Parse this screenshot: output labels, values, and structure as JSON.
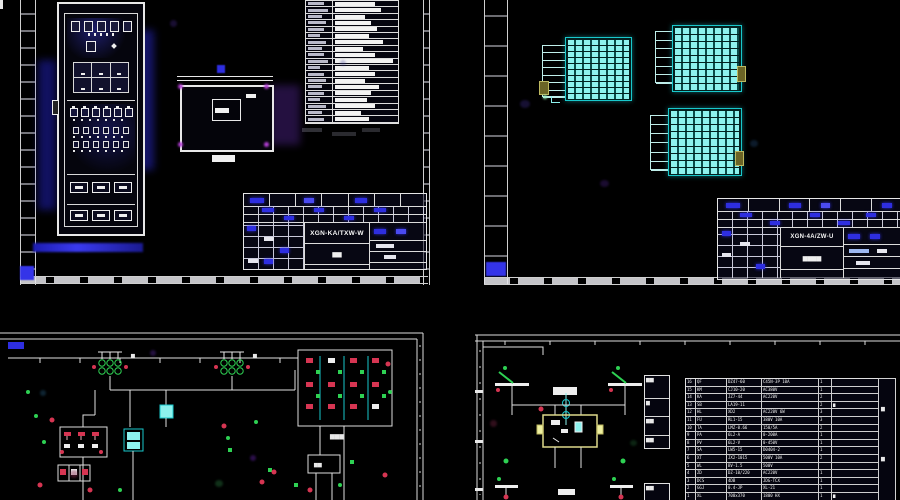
{
  "palette": {
    "line": "#e8e8e8",
    "blue": "#2e2ee0",
    "cyan_fill": "#8df2ee",
    "cyan_line": "#19c8cc",
    "green": "#2ed153",
    "red": "#d63552",
    "yellow": "#ddd98a",
    "magenta": "#a64fd4"
  },
  "sheet1": {
    "name": "cabinet-layout-sheet",
    "wire_table": {
      "left_widths": [
        16,
        20,
        14,
        18,
        16,
        12,
        18,
        14,
        16,
        20,
        12,
        16,
        18,
        14,
        16,
        12,
        18,
        14,
        16
      ],
      "bar_widths": [
        40,
        46,
        30,
        36,
        42,
        34,
        48,
        28,
        40,
        58,
        34,
        40,
        30,
        44,
        36,
        32,
        40,
        26,
        34
      ]
    },
    "title_block": {
      "model": "XGN-KA/TXW-W",
      "subtitle": "▆▆"
    }
  },
  "sheet2": {
    "name": "terminal-arrangement-sheet",
    "terminal_tables": [
      {
        "rows": 10,
        "aux_rows": 7
      },
      {
        "rows": 9,
        "aux_rows": 6
      },
      {
        "rows": 9,
        "aux_rows": 6
      }
    ],
    "title_block": {
      "model": "XGN-4A/ZW-U",
      "subtitle": "▆▆▆▆"
    }
  },
  "sheet3": {
    "name": "control-schematic-sheet",
    "labels": {
      "t1": "▆",
      "t2": "▆",
      "grid": "▆▆▆",
      "box": "▆▆"
    }
  },
  "sheet4": {
    "name": "secondary-schematic-sheet",
    "labels": {
      "bar": "▆▆",
      "t": "▆▆",
      "strip1": "▆",
      "strip2": "▆"
    },
    "side_table_a": [
      "▆▆",
      "▆",
      "▆▆",
      "▆▆"
    ],
    "side_table_b": [
      "▆▆"
    ],
    "bom": {
      "rows": [
        [
          "16",
          "QF",
          "DZ47-60",
          "C45N-3P 10A",
          "1",
          ""
        ],
        [
          "15",
          "KM",
          "CJ10-20",
          "AC380V",
          "1",
          ""
        ],
        [
          "14",
          "KA",
          "JZ7-44",
          "AC220V",
          "2",
          ""
        ],
        [
          "13",
          "SB",
          "LA19-11",
          "",
          "2",
          "▆"
        ],
        [
          "12",
          "HL",
          "XD2",
          "AC220V 6W",
          "3",
          ""
        ],
        [
          "11",
          "FU",
          "RL1-15",
          "380V 10A",
          "3",
          ""
        ],
        [
          "10",
          "TA",
          "LMZ-0.66",
          "150/5A",
          "2",
          ""
        ],
        [
          "9",
          "PA",
          "6L2-A",
          "0-200A",
          "1",
          ""
        ],
        [
          "8",
          "PV",
          "6L2-V",
          "0-450V",
          "1",
          ""
        ],
        [
          "7",
          "SA",
          "LW5-15",
          "D0404-2",
          "1",
          ""
        ],
        [
          "6",
          "XT",
          "JX2-1015",
          "500V 10A",
          "2",
          ""
        ],
        [
          "5",
          "WL",
          "BV-1.5",
          "500V",
          "",
          ""
        ],
        [
          "4",
          "ZD",
          "DZ-10/220",
          "AC220V",
          "1",
          ""
        ],
        [
          "3",
          "DCS",
          "4DB",
          "JDG-TCX",
          "1",
          ""
        ],
        [
          "2",
          "GGJ",
          "0.4-JP",
          "XL-21",
          "1",
          ""
        ],
        [
          "1",
          "XL",
          "700x370",
          "1800 HX",
          "1",
          "▆"
        ]
      ]
    }
  }
}
